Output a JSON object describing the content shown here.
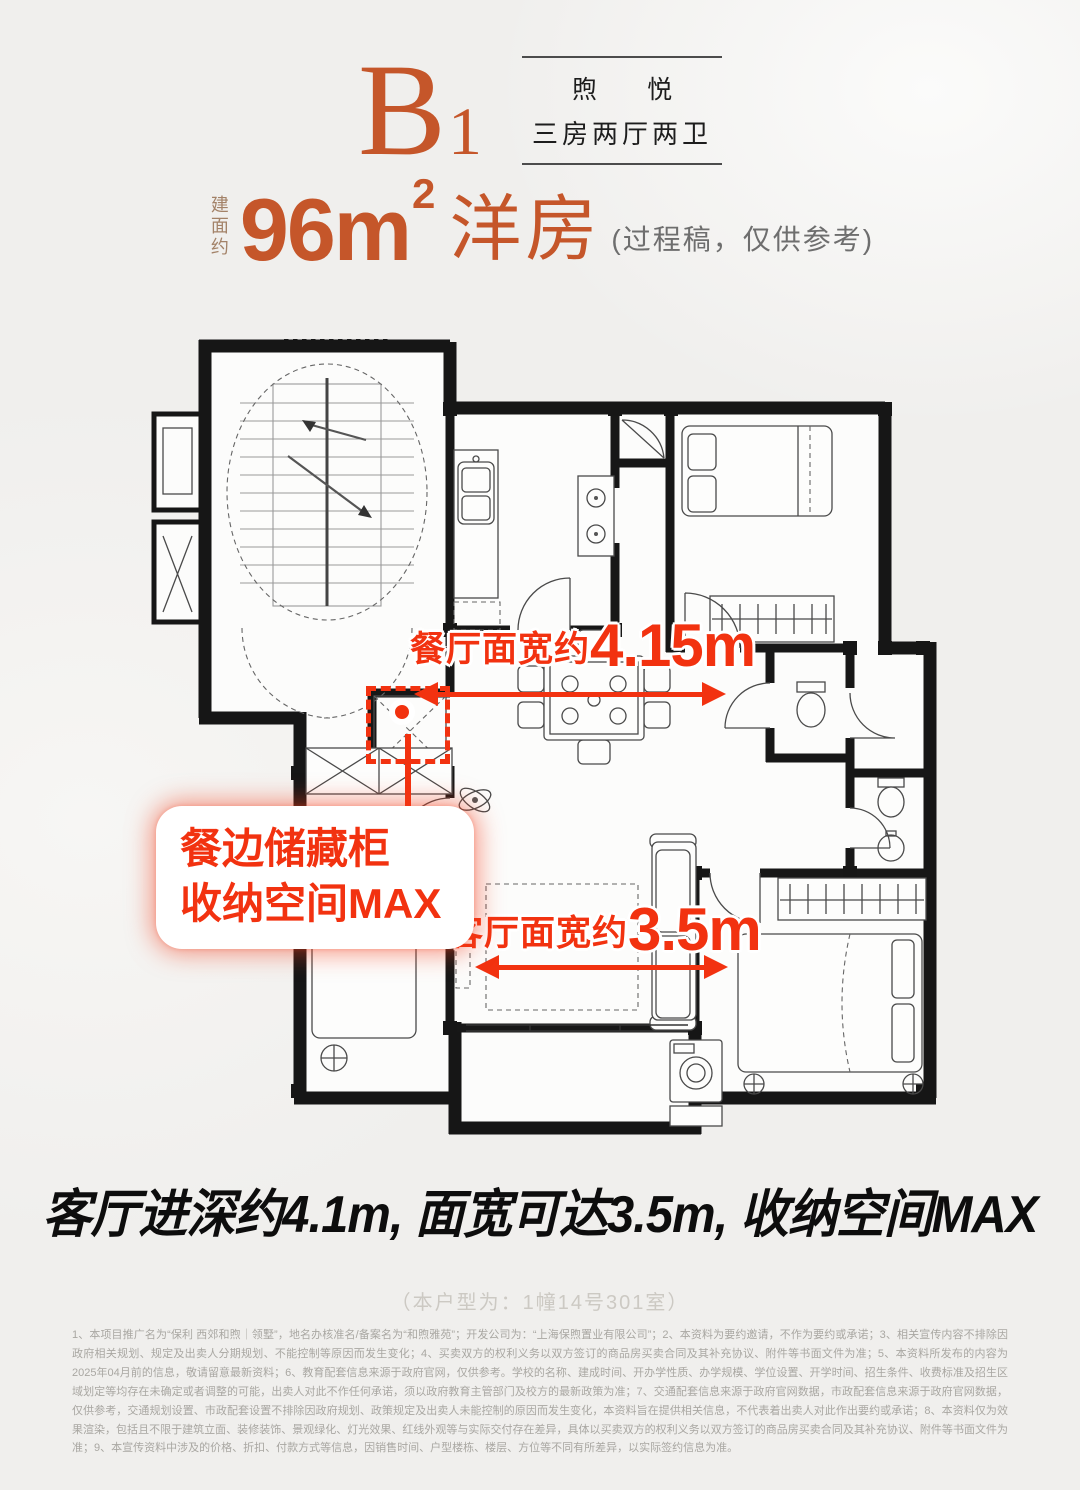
{
  "header": {
    "unit_code": "B",
    "unit_code_sub": "1",
    "project_name": "煦 悦",
    "unit_layout": "三房两厅两卫"
  },
  "area": {
    "prefix": "建面约",
    "value": "96m",
    "sup": "2",
    "suffix": "洋房",
    "note": "(过程稿，仅供参考)"
  },
  "plan_annotations": {
    "dining": {
      "label": "餐厅面宽约",
      "value": "4.15m"
    },
    "living": {
      "label": "客厅面宽约",
      "value": "3.5m"
    },
    "storage": {
      "line1": "餐边储藏柜",
      "line2": "收纳空间MAX"
    }
  },
  "tagline": "客厅进深约4.1m, 面宽可达3.5m, 收纳空间MAX",
  "unit_note": "（本户型为：1幢14号301室）",
  "disclaimer": "1、本项目推广名为“保利 西郊和煦｜领墅”，地名办核准名/备案名为“和煦雅苑”；开发公司为：“上海保煦置业有限公司”；2、本资料为要约邀请，不作为要约或承诺；3、相关宣传内容不排除因政府相关规划、规定及出卖人分期规划、不能控制等原因而发生变化；4、买卖双方的权利义务以双方签订的商品房买卖合同及其补充协议、附件等书面文件为准；5、本资料所发布的内容为2025年04月前的信息，敬请留意最新资料；6、教育配套信息来源于政府官网，仅供参考。学校的名称、建成时间、开办学性质、办学规模、学位设置、开学时间、招生条件、收费标准及招生区域划定等均存在未确定或者调整的可能，出卖人对此不作任何承诺，须以政府教育主管部门及校方的最新政策为准；7、交通配套信息来源于政府官网数据，市政配套信息来源于政府官网数据，仅供参考，交通规划设置、市政配套设置不排除因政府规划、政策规定及出卖人未能控制的原因而发生变化，本资料旨在提供相关信息，不代表着出卖人对此作出要约或承诺；8、本资料仅为效果渲染，包括且不限于建筑立面、装修装饰、景观绿化、灯光效果、红线外观等与实际交付存在差异，具体以买卖双方的权利义务以双方签订的商品房买卖合同及其补充协议、附件等书面文件为准；9、本宣传资料中涉及的价格、折扣、付款方式等信息，因销售时间、户型楼栋、楼层、方位等不同有所差异，以实际签约信息为准。",
  "icons": {
    "dining_width_arrow": "double-arrow-horizontal",
    "living_width_arrow": "double-arrow-horizontal",
    "storage_marker": "red-dot-marker"
  },
  "colors": {
    "accent_orange": "#C5562A",
    "annotation_red": "#F23210",
    "wall_black": "#161616",
    "tagline_black": "#0D0D0D"
  }
}
